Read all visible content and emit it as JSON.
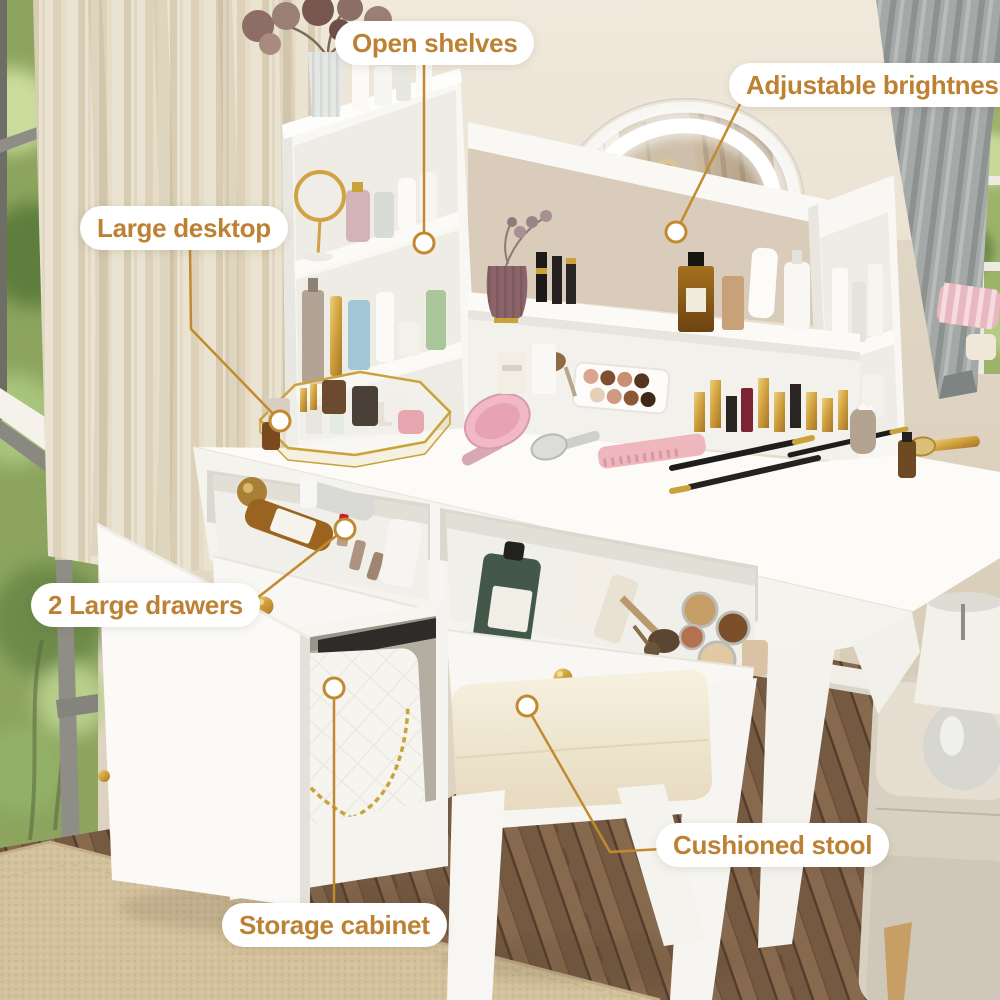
{
  "callouts": [
    {
      "id": "open-shelves",
      "label": "Open shelves"
    },
    {
      "id": "adjustable-brightness",
      "label": "Adjustable brightness"
    },
    {
      "id": "large-desktop",
      "label": "Large desktop"
    },
    {
      "id": "two-large-drawers",
      "label": "2 Large drawers"
    },
    {
      "id": "cushioned-stool",
      "label": "Cushioned stool"
    },
    {
      "id": "storage-cabinet",
      "label": "Storage cabinet"
    }
  ],
  "colors": {
    "label_text": "#BD8133",
    "label_background": "#FFFFFF",
    "connector": "#C28A30",
    "hardware_gold": "#D5A43C"
  }
}
